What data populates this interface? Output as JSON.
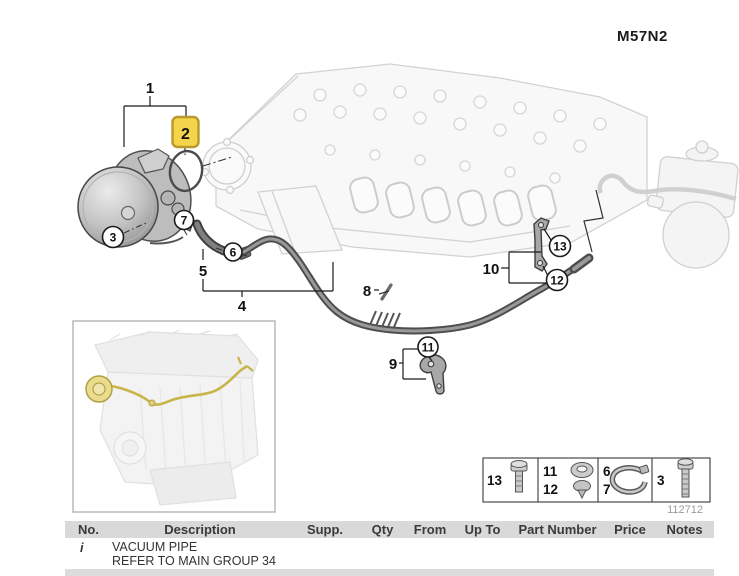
{
  "window": {
    "width": 739,
    "height": 575
  },
  "header": {
    "model_code": "M57N2"
  },
  "diagram": {
    "name": "vacuum-pipe-parts-diagram",
    "highlighted_callout": "2",
    "callouts": {
      "c1": "1",
      "c2": "2",
      "c3": "3",
      "c4": "4",
      "c5": "5",
      "c6": "6",
      "c7": "7",
      "c8": "8",
      "c9": "9",
      "c10": "10",
      "c11": "11",
      "c12": "12",
      "c13": "13"
    },
    "diagram_number": "112712"
  },
  "legend": {
    "cells": [
      {
        "numbers": [
          "13"
        ],
        "icon": "bolt-icon"
      },
      {
        "numbers": [
          "11",
          "12"
        ],
        "icon": "grommet-icon"
      },
      {
        "numbers": [
          "6",
          "7"
        ],
        "icon": "hose-clamp-icon"
      },
      {
        "numbers": [
          "3"
        ],
        "icon": "long-bolt-icon"
      }
    ]
  },
  "colors": {
    "highlight_bg": "#F3D44B",
    "highlight_border": "#B9992F",
    "table_header_bg": "#D9D9D9",
    "inset_pipe_highlight": "#C9B44A",
    "diagram_number_color": "#9A9A9A"
  },
  "table": {
    "columns": [
      "No.",
      "Description",
      "Supp.",
      "Qty",
      "From",
      "Up To",
      "Part Number",
      "Price",
      "Notes"
    ],
    "rows": [
      {
        "no": "i",
        "description": [
          "VACUUM PIPE",
          "REFER TO MAIN GROUP 34"
        ],
        "supp": "",
        "qty": "",
        "from": "",
        "up_to": "",
        "part_number": "",
        "price": "",
        "notes": ""
      }
    ]
  }
}
